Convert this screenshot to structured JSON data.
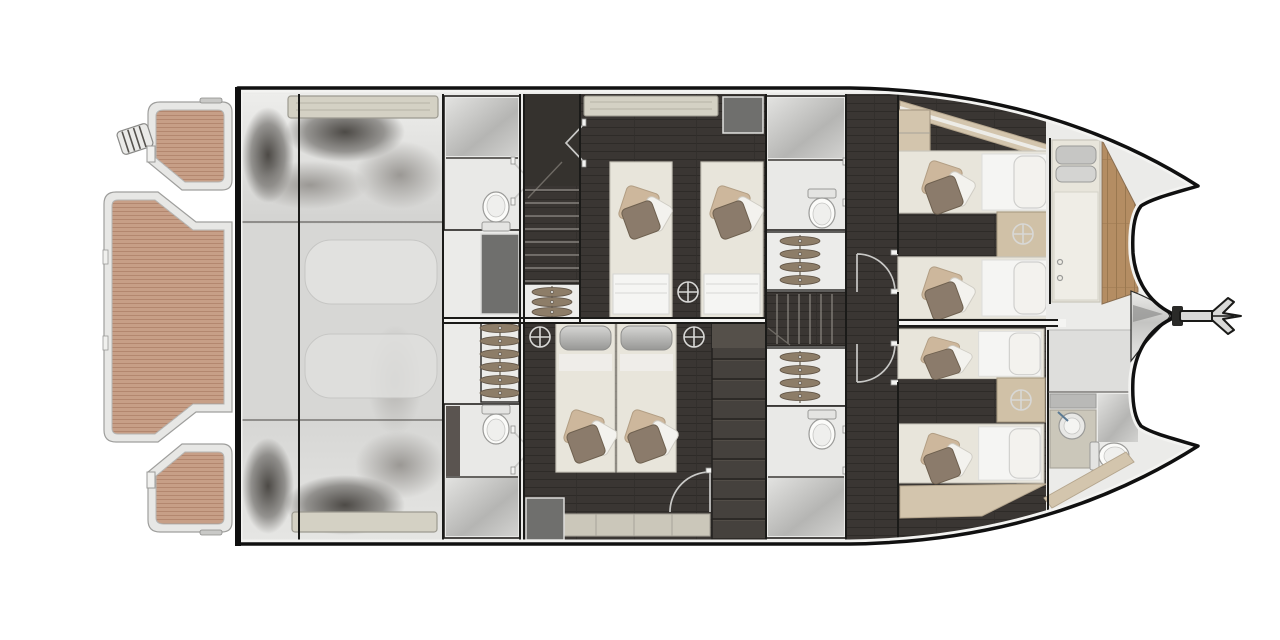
{
  "diagram": {
    "title": "power-catamaran-lower-deck-floor-plan",
    "orientation": "bow-right-stern-left",
    "rooms": [
      {
        "id": "swim-platform",
        "features": [
          "teak-decking-3-pads",
          "boarding-ladder",
          "cleats"
        ]
      },
      {
        "id": "engine-room",
        "features": [
          "twin-engine-blocks",
          "deck-hatch",
          "aft-bench"
        ]
      },
      {
        "id": "aft-head-port",
        "features": [
          "shower",
          "toilet",
          "door"
        ]
      },
      {
        "id": "aft-head-starboard",
        "features": [
          "toilet",
          "shower",
          "door"
        ]
      },
      {
        "id": "aft-stairs",
        "features": [
          "companionway-steps",
          "hanging-locker"
        ]
      },
      {
        "id": "midship-cabin-port",
        "features": [
          "twin-berths-2",
          "overhead-hatch",
          "reading-light"
        ]
      },
      {
        "id": "midship-cabin-starboard",
        "features": [
          "double-berth-2-singles",
          "bench",
          "wardrobe",
          "reading-lights-2",
          "door"
        ]
      },
      {
        "id": "forward-stairs",
        "features": [
          "companionway-steps"
        ]
      },
      {
        "id": "forward-closet-port",
        "features": [
          "hangers"
        ]
      },
      {
        "id": "forward-closet-starboard",
        "features": [
          "hangers"
        ]
      },
      {
        "id": "forward-head-port",
        "features": [
          "shower",
          "toilet",
          "door"
        ]
      },
      {
        "id": "forward-head-starboard",
        "features": [
          "toilet",
          "shower",
          "door"
        ]
      },
      {
        "id": "forward-cabin-port",
        "features": [
          "berths-2",
          "nightstand",
          "reading-light",
          "cabinet"
        ]
      },
      {
        "id": "forward-cabin-starboard",
        "features": [
          "berths-2",
          "nightstand",
          "reading-light"
        ]
      },
      {
        "id": "bow-berth",
        "features": [
          "single-berth",
          "gray-pillows-2",
          "wood-sole"
        ]
      },
      {
        "id": "bow-head",
        "features": [
          "sink",
          "toilet",
          "shower"
        ]
      },
      {
        "id": "anchor",
        "features": [
          "plow-anchor-at-bow-centerline"
        ]
      }
    ],
    "inventory": {
      "berth_count": 9,
      "toilet_count": 5,
      "shower_count": 4,
      "sink_count": 1,
      "hanging_locker_count": 4,
      "staircase_count": 2,
      "reading_light_count": 5,
      "door_symbol_count": 8
    }
  },
  "palette": {
    "teak": "#c79f87",
    "teak_stripe": "#b3876f",
    "platform_frame": "#e7e7e5",
    "hull_fill": "#ebebe9",
    "hull_outline": "#101010",
    "wood_floor": "#3a3633",
    "bow_wood": "#b48d63",
    "bed": "#e8e5db",
    "duvet": "#f5f5f3",
    "pillow_white": "#f3f2ee",
    "pillow_brown": "#8b7b6b",
    "pillow_beige": "#cdb79c",
    "nightstand": "#d0c1a7",
    "cabinet": "#d3c5ad",
    "bench": "#cbc7ba",
    "hatch": "#d4d1c4",
    "bath": "#e9e9e7",
    "fixture": "#fbfbf9",
    "wardrobe": "#45413d",
    "closet": "#ececea",
    "hanger": "#8d7d68",
    "locker_gray": "#6f6f6d",
    "door_symbol": "#c9c9c7",
    "metal": "#d9d9d7"
  }
}
